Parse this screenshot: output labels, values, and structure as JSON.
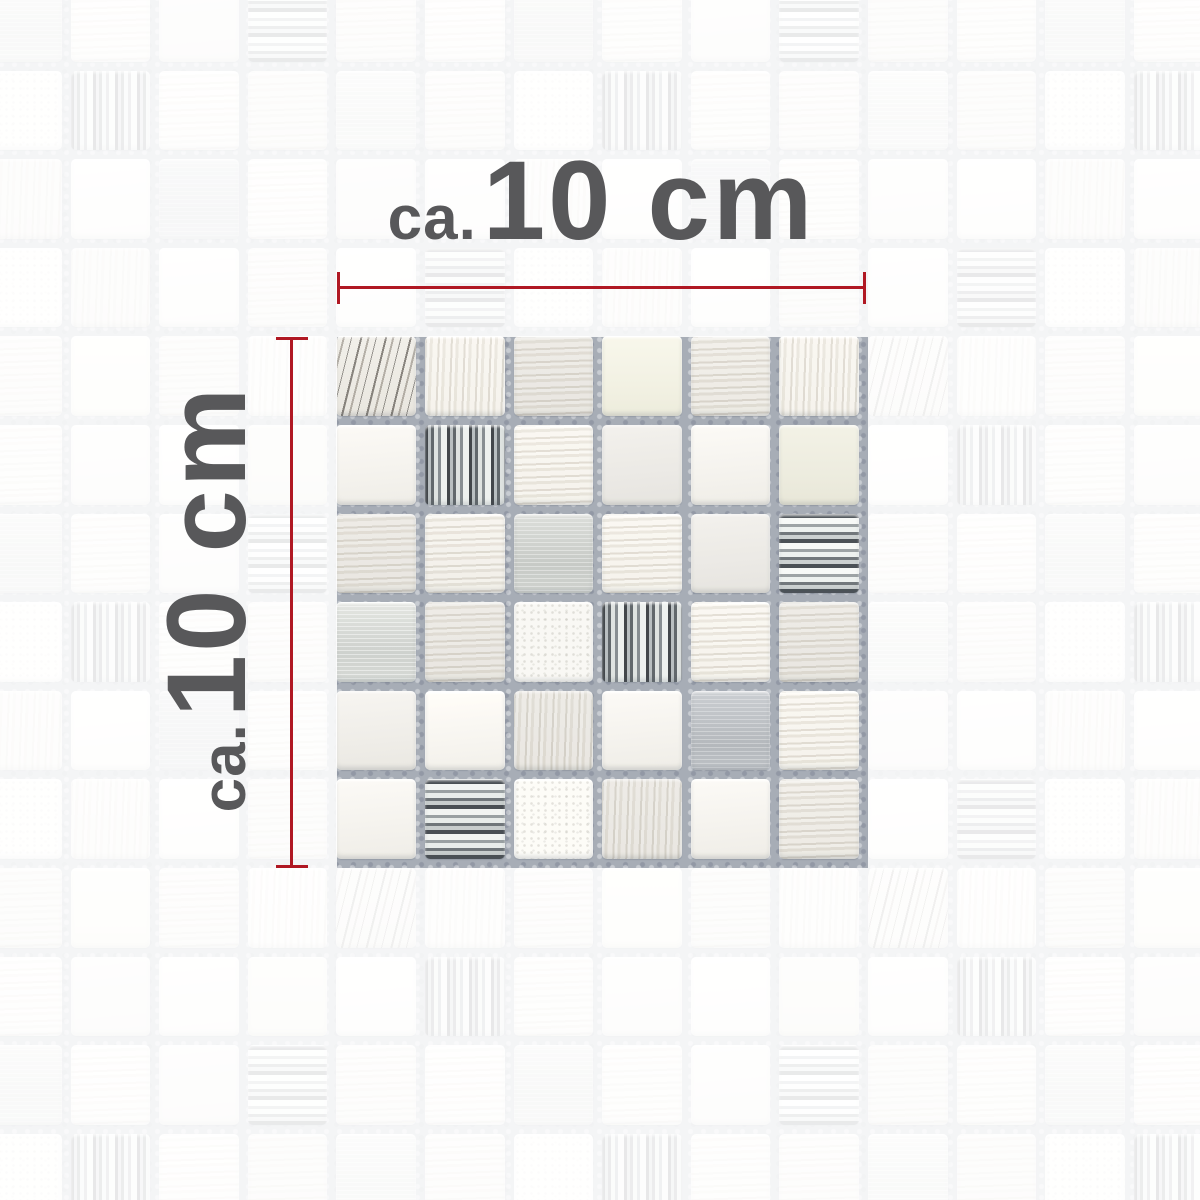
{
  "product_image": {
    "description": "Mosaic tile sample sheet photo, grey-white natural stone with brushed metal and silver glass chips, shown on faded mosaic background",
    "sample": {
      "rows": 6,
      "cols": 6
    }
  },
  "dimensions": {
    "horizontal": {
      "prefix": "ca.",
      "value": "10 cm"
    },
    "vertical": {
      "prefix": "ca.",
      "value": "10 cm"
    }
  },
  "colors": {
    "dimension_line": "#b01823",
    "label_text": "#58585a",
    "grout": "#a7adb6",
    "fade_overlay": "rgba(255,255,255,0.88)"
  },
  "mosaic": {
    "rows": 6,
    "cols": 6,
    "tile_types": [
      "light",
      "cream",
      "striped",
      "vgrain",
      "veined",
      "textured",
      "metal",
      "metal-dark",
      "chrome",
      "chrome-h"
    ],
    "grid": [
      [
        "veined",
        "vgrain",
        "striped",
        "cream",
        "striped",
        "vgrain"
      ],
      [
        "light",
        "chrome",
        "striped",
        "light",
        "light",
        "cream"
      ],
      [
        "striped",
        "striped",
        "metal",
        "striped",
        "light",
        "chrome-h"
      ],
      [
        "metal",
        "striped",
        "textured",
        "chrome",
        "striped",
        "striped"
      ],
      [
        "light",
        "light",
        "vgrain",
        "light",
        "metal-dark",
        "striped"
      ],
      [
        "light",
        "chrome-h",
        "textured",
        "vgrain",
        "light",
        "striped"
      ]
    ]
  }
}
